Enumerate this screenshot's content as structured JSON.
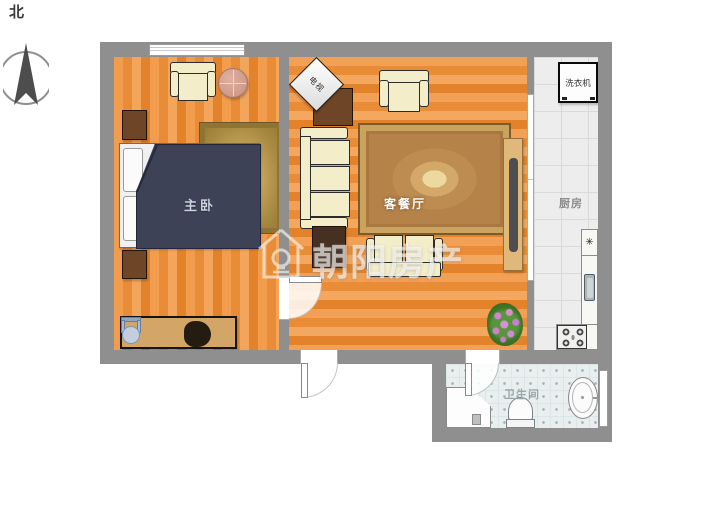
{
  "meta": {
    "type": "apartment-floor-plan"
  },
  "compass": {
    "north_label": "北"
  },
  "watermark": {
    "brand": "朝阳房产"
  },
  "rooms": {
    "master_bedroom": {
      "label": "主卧"
    },
    "living_dining": {
      "label": "客餐厅"
    },
    "kitchen": {
      "label": "厨房"
    },
    "bathroom": {
      "label": "卫生间"
    }
  },
  "appliances": {
    "washing_machine": {
      "label": "洗衣机"
    },
    "tv": {
      "label": "电视"
    },
    "stove_burner_symbol": "✳"
  },
  "colors": {
    "wall": "#8f8f8f",
    "wood_floor": "#ee9140",
    "kitchen_floor": "#ededed",
    "bathroom_floor": "#e9efef",
    "bed_duvet": "#3d4257",
    "bedroom_rug": "#bfa055",
    "living_rug": "#b5834a",
    "sofa_cream": "#f3eec9",
    "cabinet_brown": "#6e4527",
    "desk": "#d3a566",
    "watermark_text": "#ffffff"
  }
}
